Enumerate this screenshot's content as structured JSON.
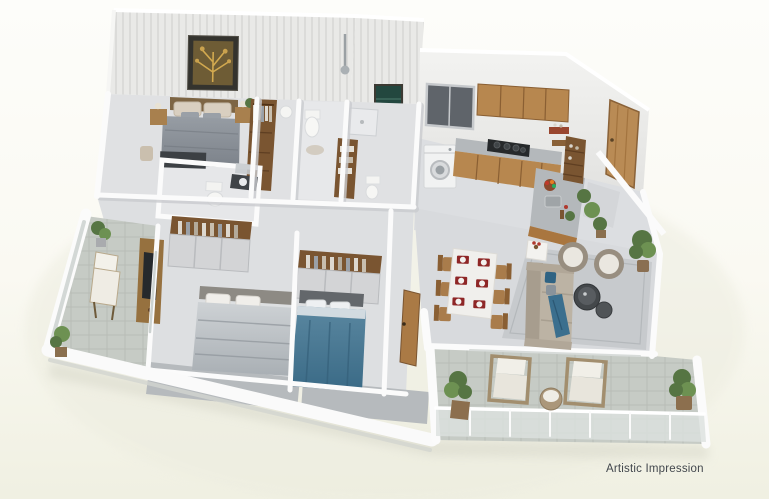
{
  "caption": "Artistic Impression",
  "scene": {
    "type": "isometric-3d-floor-plan",
    "description": "3D rendered apartment floor plan viewed from above on a cream background",
    "rooms": [
      "master-bedroom",
      "master-wardrobe",
      "toilet-1",
      "shower-bathroom",
      "kitchen",
      "entrance-foyer",
      "toilet-2",
      "bedroom-2",
      "bedroom-3",
      "hallway",
      "living-dining-room",
      "left-balcony",
      "main-balcony"
    ],
    "furniture": [
      "double-bed-gray",
      "wall-art",
      "nightstands",
      "foot-bench",
      "open-wardrobe-with-clothes",
      "toilet",
      "washbasin",
      "shower",
      "linen-cabinet",
      "washing-machine",
      "kitchen-window",
      "upper-cabinets",
      "gas-stove",
      "kitchen-counter",
      "sink",
      "fruit-bowl",
      "island-counter",
      "open-shelves",
      "entrance-door-open",
      "dining-table-six-seats",
      "red-placemats",
      "sofa-with-blue-cushions",
      "barrel-armchairs",
      "round-coffee-tables",
      "side-table-with-flowers",
      "gray-rug",
      "tv-console",
      "double-bed-silver",
      "double-bed-blue",
      "rattan-lounge-chairs",
      "balcony-side-table",
      "potted-plants",
      "glass-railing"
    ]
  },
  "colors": {
    "bg-top": "#fdfdfa",
    "bg-bottom": "#f0f0e2",
    "wall-white": "#fbfbfb",
    "wall-shadow": "#c9cbce",
    "floor-light": "#e0e1e3",
    "floor-mid": "#d8dadd",
    "balcony-floor": "#c6cbc5",
    "ledge-gray": "#b6babd",
    "wood": "#b7874f",
    "wood-dark": "#7a5531",
    "door-wood": "#b98b55",
    "bed-gray": "#878d94",
    "bed-silver": "#c0c5c9",
    "bed-blue": "#47748f",
    "sofa-beige": "#bcb3a4",
    "cushion-blue": "#2f6383",
    "armchair-taupe": "#988e80",
    "placemat-red": "#8e2626",
    "plant-green": "#567543",
    "plant-green-light": "#6d9152",
    "counter-dark": "#3f4347",
    "stove-black": "#26292b",
    "window-dark": "#5f646a",
    "board-teal": "#23473f",
    "caption-text": "#42474d"
  }
}
